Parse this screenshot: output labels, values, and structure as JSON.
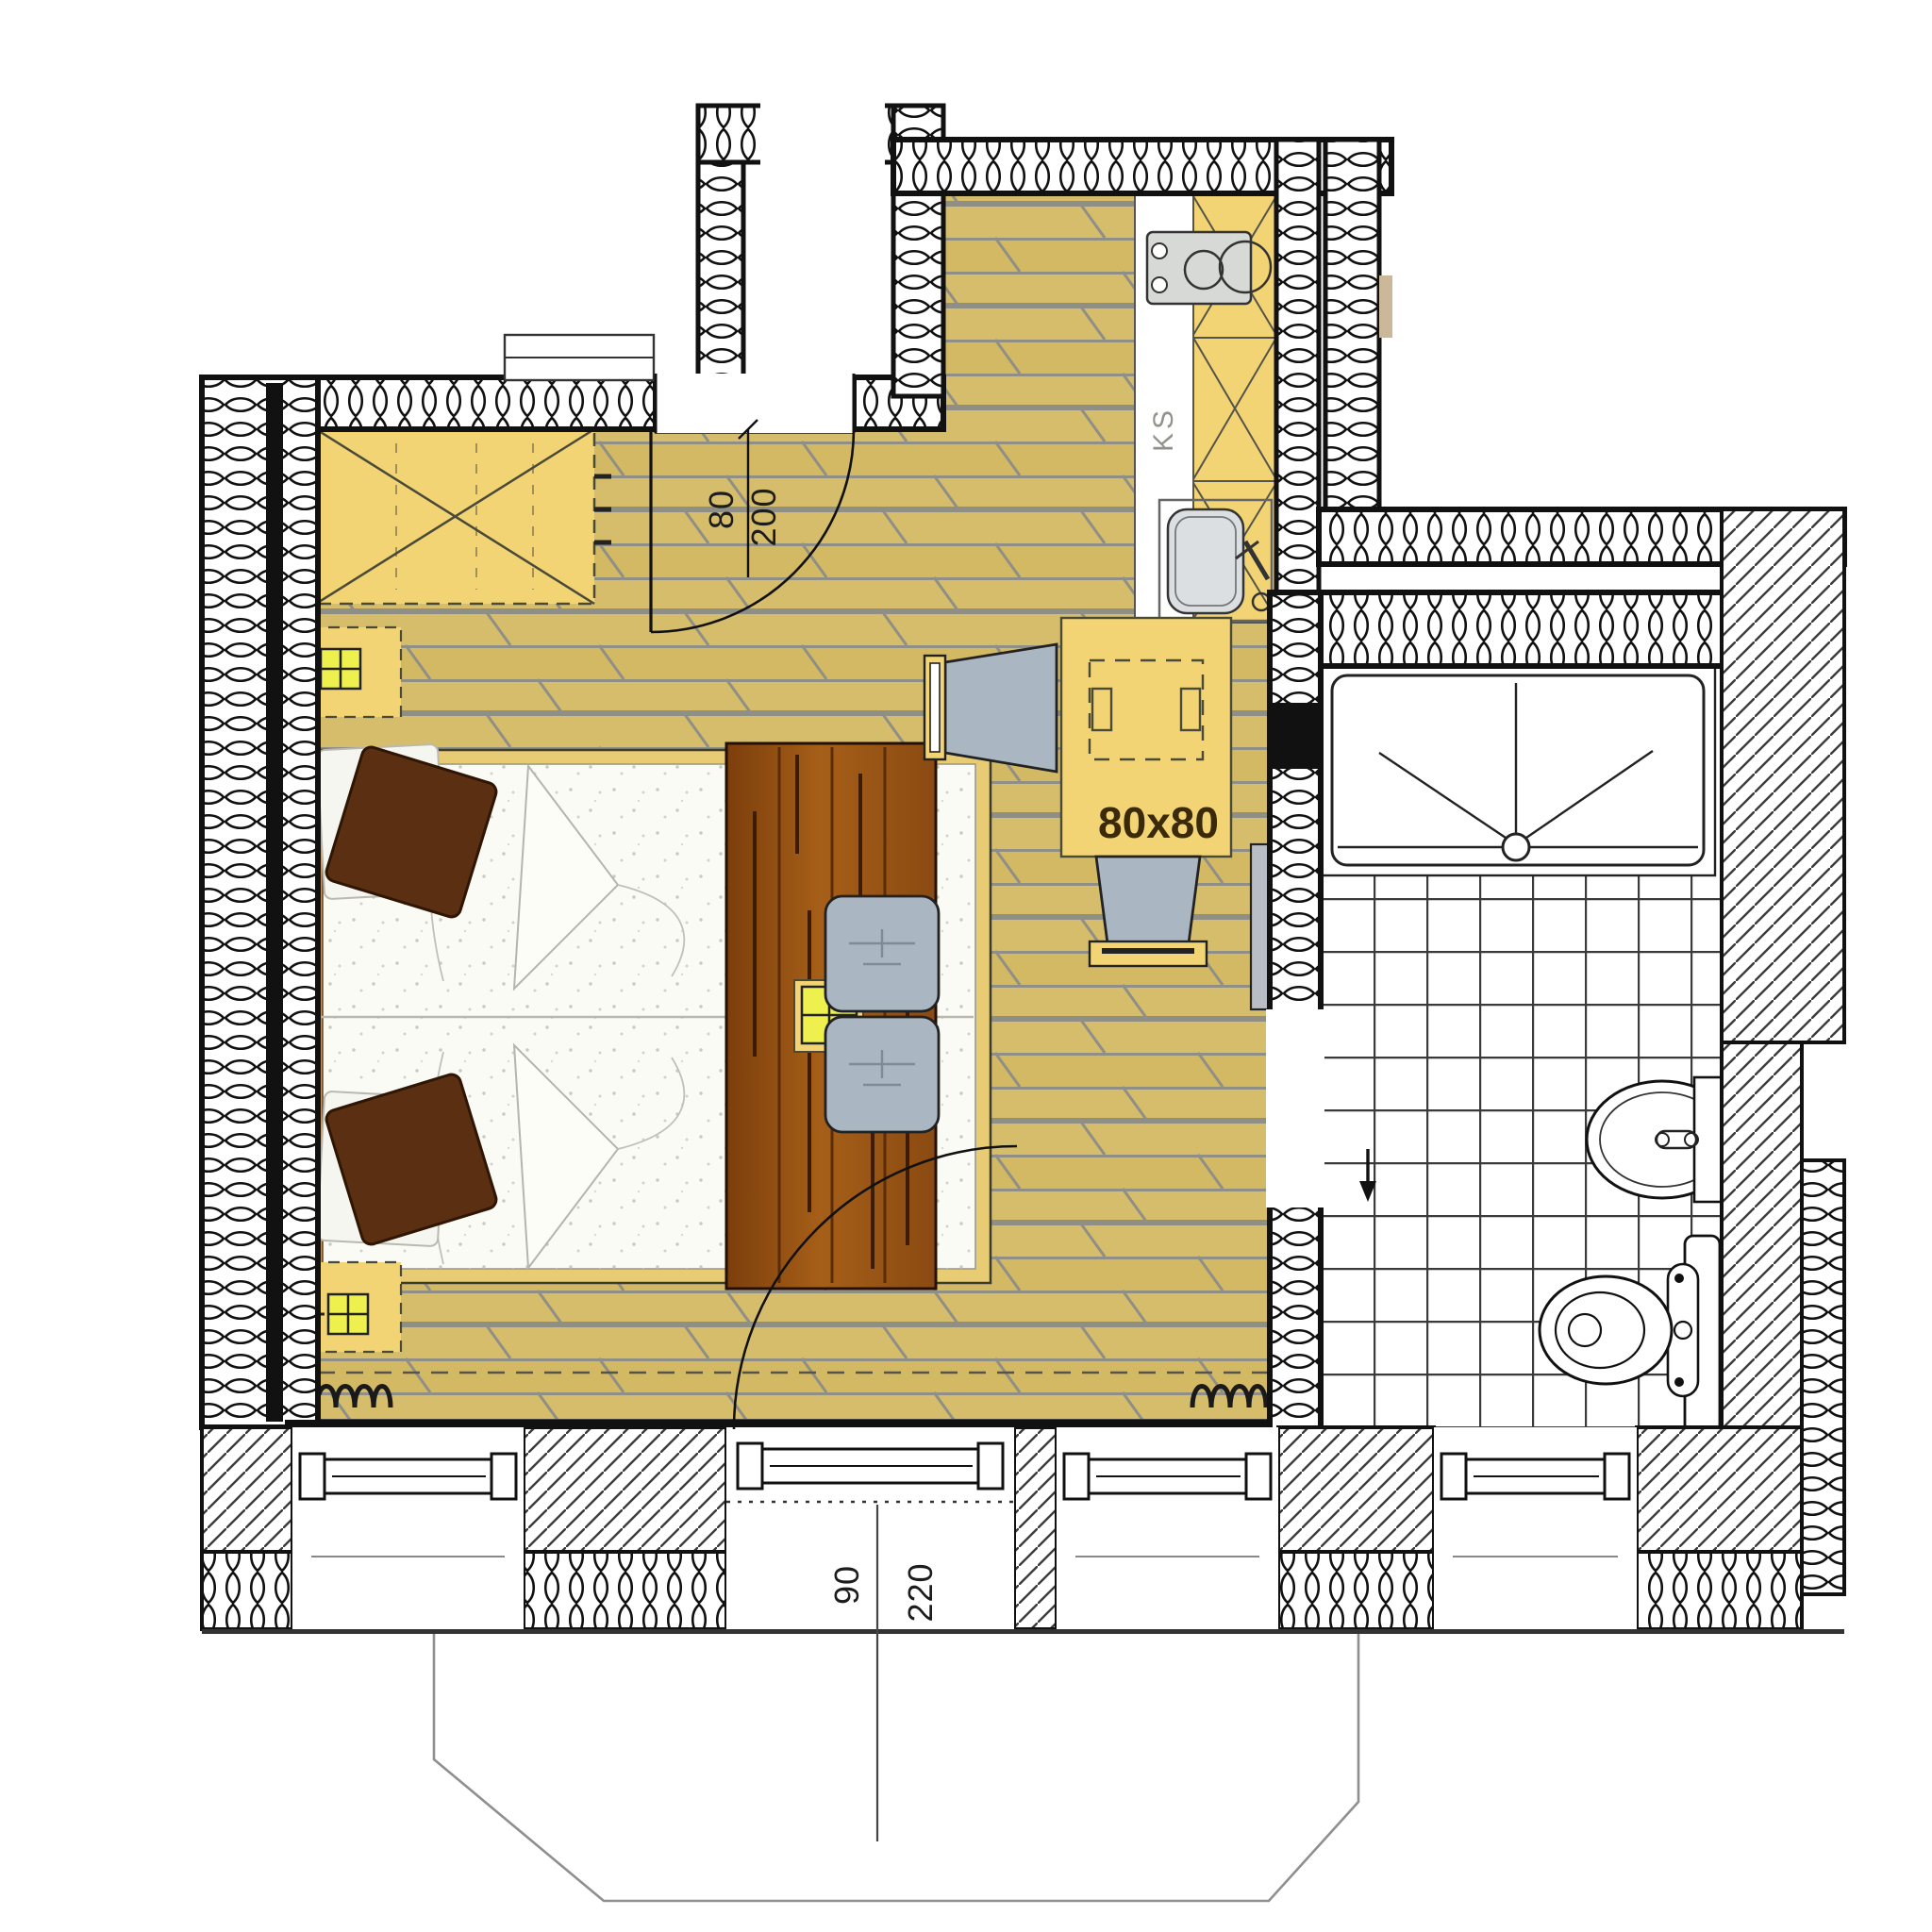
{
  "plan": {
    "type": "apartment-floor-plan",
    "labels": {
      "entry_door": {
        "width": "80",
        "height": "200"
      },
      "balcony_door": {
        "width": "90",
        "height": "220"
      },
      "table": "80x80",
      "kitchen_unit": "KS"
    },
    "colors": {
      "parquet": "#d6bd6b",
      "plank_line": "#8f8f85",
      "furniture_yellow": "#f2d475",
      "lamp_yellow": "#eef04e",
      "pillow_brown": "#5b3012",
      "bench_brown": "#8a4a12",
      "headboard_tan": "#c9996a",
      "seat_grey": "#aab6c2",
      "wall_black": "#111111",
      "tile_line": "#3a3a3a"
    }
  }
}
